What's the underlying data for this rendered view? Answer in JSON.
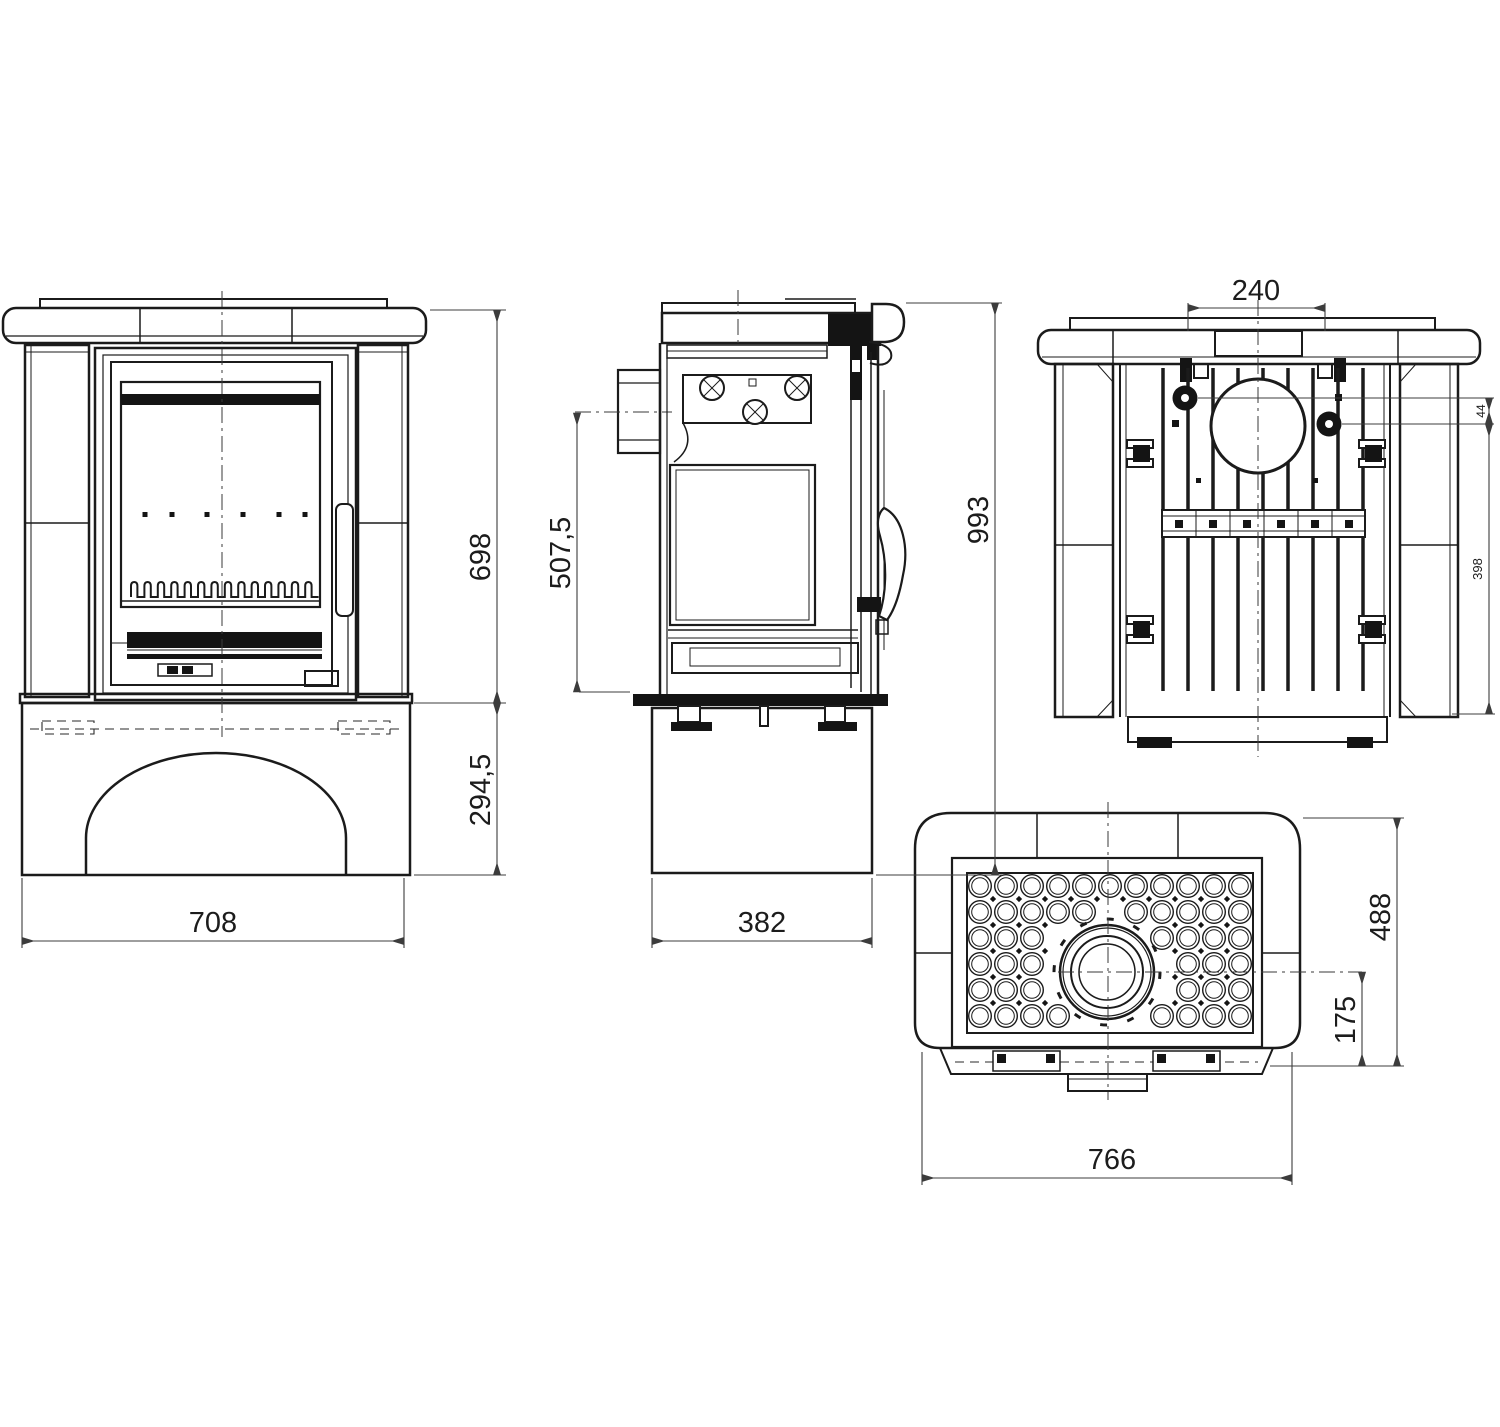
{
  "drawing": {
    "background": "#ffffff",
    "line_color": "#1b1b1b",
    "dim_color": "#3c3c3c",
    "views": {
      "front": {
        "dims": {
          "overall_width": "708",
          "body_height": "698",
          "base_height": "294,5"
        }
      },
      "side": {
        "dims": {
          "base_depth": "382",
          "flue_axis_height": "507,5",
          "overall_height": "993"
        }
      },
      "rear": {
        "dims": {
          "flue_spacing": "240",
          "knob_offset": "44",
          "rear_height": "398"
        }
      },
      "top": {
        "dims": {
          "overall_width": "766",
          "overall_depth": "488",
          "flue_center_offset": "175"
        }
      }
    }
  }
}
